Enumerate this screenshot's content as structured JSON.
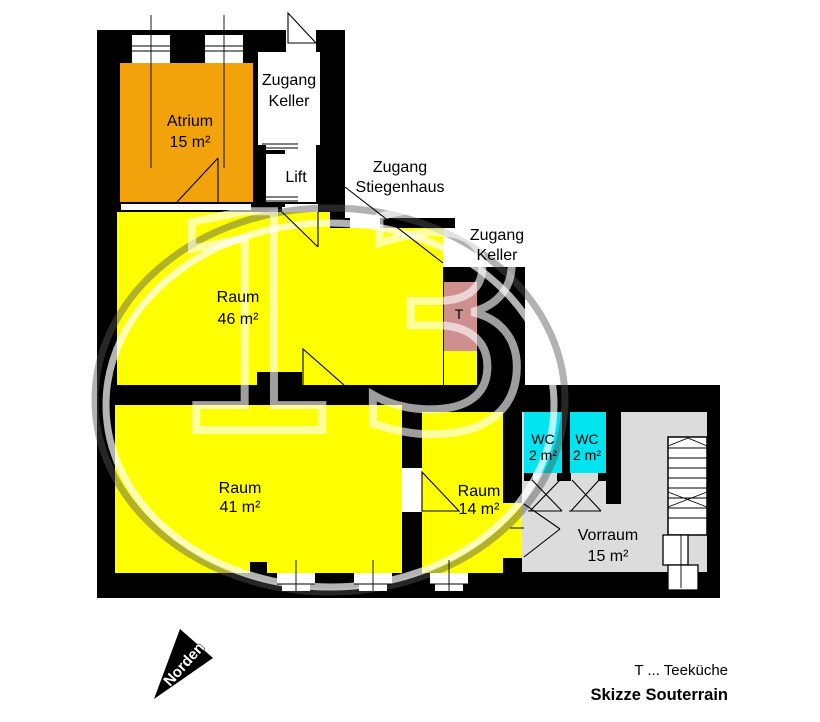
{
  "plan": {
    "labels": {
      "atrium_name": "Atrium",
      "atrium_area": "15 m²",
      "zugang_keller_top_1": "Zugang",
      "zugang_keller_top_2": "Keller",
      "lift": "Lift",
      "zugang_stiegenhaus_1": "Zugang",
      "zugang_stiegenhaus_2": "Stiegenhaus",
      "zugang_keller_right_1": "Zugang",
      "zugang_keller_right_2": "Keller",
      "raum46_name": "Raum",
      "raum46_area": "46 m²",
      "tee_symbol": "T",
      "raum41_name": "Raum",
      "raum41_area": "41 m²",
      "raum14_name": "Raum",
      "raum14_area": "14 m²",
      "wc1_name": "WC",
      "wc1_area": "2 m²",
      "wc2_name": "WC",
      "wc2_area": "2 m²",
      "vorraum_name": "Vorraum",
      "vorraum_area": "15 m²"
    },
    "colors": {
      "wall": "#000000",
      "atrium": "#F2A30B",
      "room_yellow": "#FFFF00",
      "tee": "#CE8F8F",
      "wc": "#00E4EF",
      "vorraum": "#DCDCDC"
    },
    "watermark": "13",
    "compass_label": "Norden",
    "legend_t": "T ... Teeküche",
    "caption": "Skizze Souterrain"
  }
}
